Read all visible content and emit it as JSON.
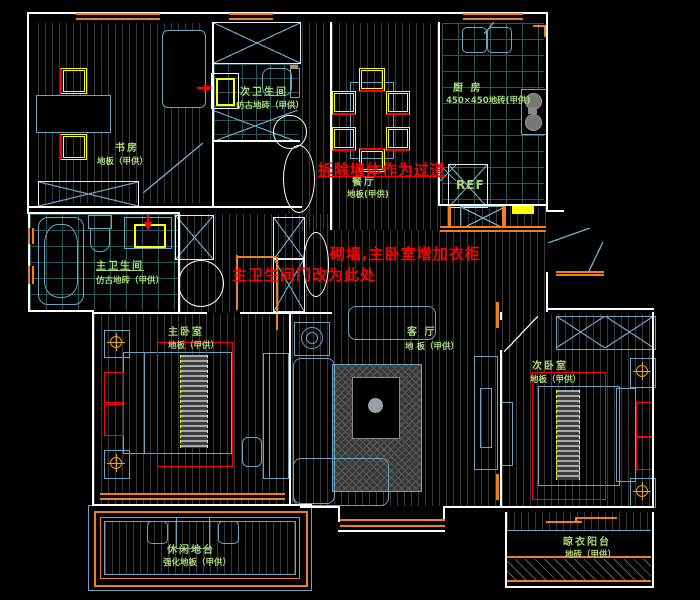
{
  "title": "apartment-renovation-floor-plan",
  "colors": {
    "background": "#000000",
    "wall": "#ffffff",
    "furniture": "#6da4bf",
    "window": "#f07f1e",
    "hatch": "#383838",
    "tile_grid": "#2a5858",
    "room_label": "#a8d878",
    "annotation": "#ff0000",
    "chair": "#ffff00"
  },
  "annotations": [
    {
      "text": "拆除墙体作为过道"
    },
    {
      "text": "砌墙,主卧室增加衣柜"
    },
    {
      "text": "主卫生间门改为此处"
    }
  ],
  "rooms": {
    "study": {
      "name": "书房",
      "material": "地板（甲供）"
    },
    "second_bath": {
      "name": "次卫生间",
      "material": "仿古地砖（甲供）"
    },
    "dining": {
      "name": "餐厅",
      "material": "地板(甲供)"
    },
    "kitchen": {
      "name": "厨 房",
      "material": "450×450地砖(甲供)"
    },
    "master_bath": {
      "name": "主卫生间",
      "material": "仿古地砖（甲供）"
    },
    "master_bedroom": {
      "name": "主卧室",
      "material": "地板（甲供）"
    },
    "living": {
      "name": "客 厅",
      "material": "地 板（甲供）"
    },
    "second_bedroom": {
      "name": "次卧室",
      "material": "地板（甲供）"
    },
    "leisure_balcony": {
      "name": "休闲地台",
      "material": "强化地板（甲供）"
    },
    "laundry_balcony": {
      "name": "晾衣阳台",
      "material": "地砖（甲供）"
    }
  },
  "appliances": {
    "fridge": "REF"
  }
}
